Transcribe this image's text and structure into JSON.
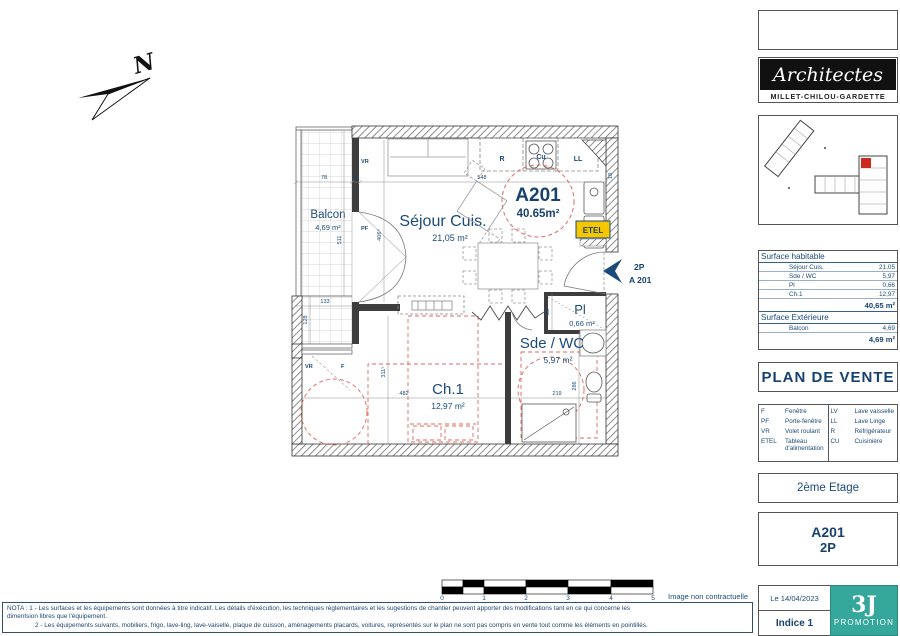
{
  "colors": {
    "navy": "#1b4a7a",
    "red": "#e0685c",
    "yellow": "#f6c700",
    "teal": "#35a79b"
  },
  "north": {
    "label": "N"
  },
  "plan": {
    "unit_circle": {
      "id": "A201",
      "area": "40.65m²"
    },
    "rooms": {
      "balcon": {
        "name": "Balcon",
        "area": "4,69 m²"
      },
      "sejour": {
        "name": "Séjour Cuis.",
        "area": "21,05 m²"
      },
      "ch1": {
        "name": "Ch.1",
        "area": "12,97 m²"
      },
      "sde": {
        "name": "Sde / WC",
        "area": "5,97 m²"
      },
      "pl": {
        "name": "Pl",
        "area": "0,66 m²"
      }
    },
    "labels": {
      "vr": "VR",
      "pf": "PF",
      "vr2": "VR",
      "f": "F",
      "r": "R",
      "cu": "Cu",
      "ll": "LL",
      "etel": "ETEL"
    },
    "entrance": {
      "type": "2P",
      "unit": "A 201"
    },
    "dims": {
      "sejour_w": "548",
      "balcon_w": "78",
      "wall_t": "36",
      "sejour_h": "406⁵",
      "balcon_h": "511",
      "terrace_w": "133",
      "terrace_h": "128",
      "ch1_w": "482",
      "ch1_h": "311⁵",
      "sde_w": "219",
      "sde_h": "286",
      "pl_h": "53",
      "wall_r": "18"
    }
  },
  "scalebar": {
    "ticks": [
      "0",
      "1",
      "2",
      "3",
      "4",
      "5"
    ],
    "disclaimer": "Image non contractuelle"
  },
  "notes": {
    "line1": "NOTA  : 1 - Les surfaces et les équipements sont données à titre indicatif. Les détails d'éxécution, les techniques réglementaires et les sugestions de chantier peuvent apporter des modifications tant  en ce qui concerne les",
    "line2": "dimentsion libres que l'équipement.",
    "line3": "2 - Les équipements suivants, mobiliers, frigo, lave-ling, lave-vaiselle, plaque de cuisson, aménagements placards, voitures, représentés sur le plan ne sont pas compris en vente tout comme les éléments en pointillés."
  },
  "sidebar": {
    "architects": {
      "script": "Architectes",
      "names": "MILLET-CHILOU-GARDETTE"
    },
    "surface_table": {
      "habitable": {
        "title": "Surface habitable",
        "rows": [
          [
            "Séjour Cuis.",
            "21,05"
          ],
          [
            "Sde / WC",
            "5,97"
          ],
          [
            "Pl",
            "0,66"
          ],
          [
            "Ch.1",
            "12,97"
          ]
        ],
        "total": "40,65 m²"
      },
      "exterieure": {
        "title": "Surface Extérieure",
        "rows": [
          [
            "Balcon",
            "4,69"
          ]
        ],
        "total": "4,69 m²"
      }
    },
    "title": "PLAN DE VENTE",
    "legend": {
      "left": [
        [
          "F",
          "Fenêtre"
        ],
        [
          "PF",
          "Porte-fenêtre"
        ],
        [
          "VR",
          "Volet roulant"
        ],
        [
          "ETEL",
          "Tableau d'alimentation"
        ]
      ],
      "right": [
        [
          "LV",
          "Lave vaisselle"
        ],
        [
          "LL",
          "Lave Linge"
        ],
        [
          "R",
          "Réfrigérateur"
        ],
        [
          "CU",
          "Cuisinière"
        ]
      ]
    },
    "floor": "2ème Etage",
    "unit": {
      "id": "A201",
      "type": "2P"
    },
    "revision": {
      "date": "Le 14/04/2023",
      "indice": "Indice 1"
    },
    "promoter": {
      "monogram": "3J",
      "name": "PROMOTION"
    }
  }
}
